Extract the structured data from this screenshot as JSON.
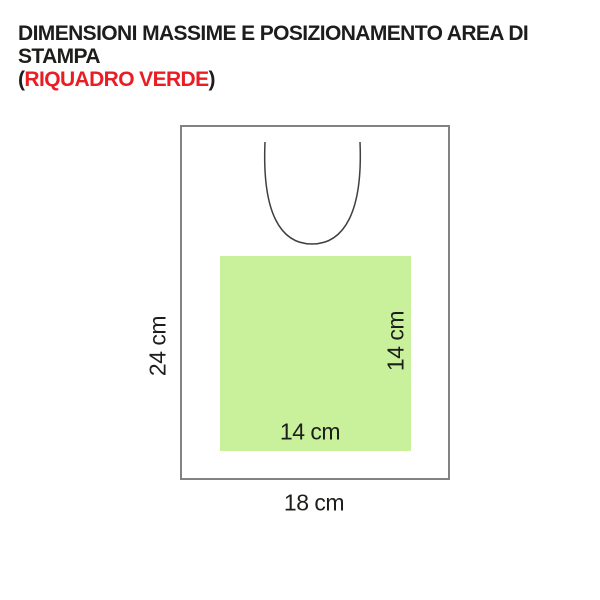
{
  "title": {
    "line1": "DIMENSIONI MASSIME E POSIZIONAMENTO AREA DI STAMPA",
    "line2": {
      "open": "(",
      "highlight": "RIQUADRO VERDE",
      "close": ")"
    }
  },
  "diagram": {
    "garment": {
      "width_label": "18 cm",
      "height_label": "24 cm"
    },
    "print_area": {
      "width_label": "14 cm",
      "height_label": "14 cm"
    }
  },
  "colors": {
    "print_area_green": "#c9f19b",
    "highlight_red": "#ea1d25",
    "outline_gray": "#828282",
    "neckline_gray": "#404040",
    "text_black": "#1d1d1b"
  }
}
